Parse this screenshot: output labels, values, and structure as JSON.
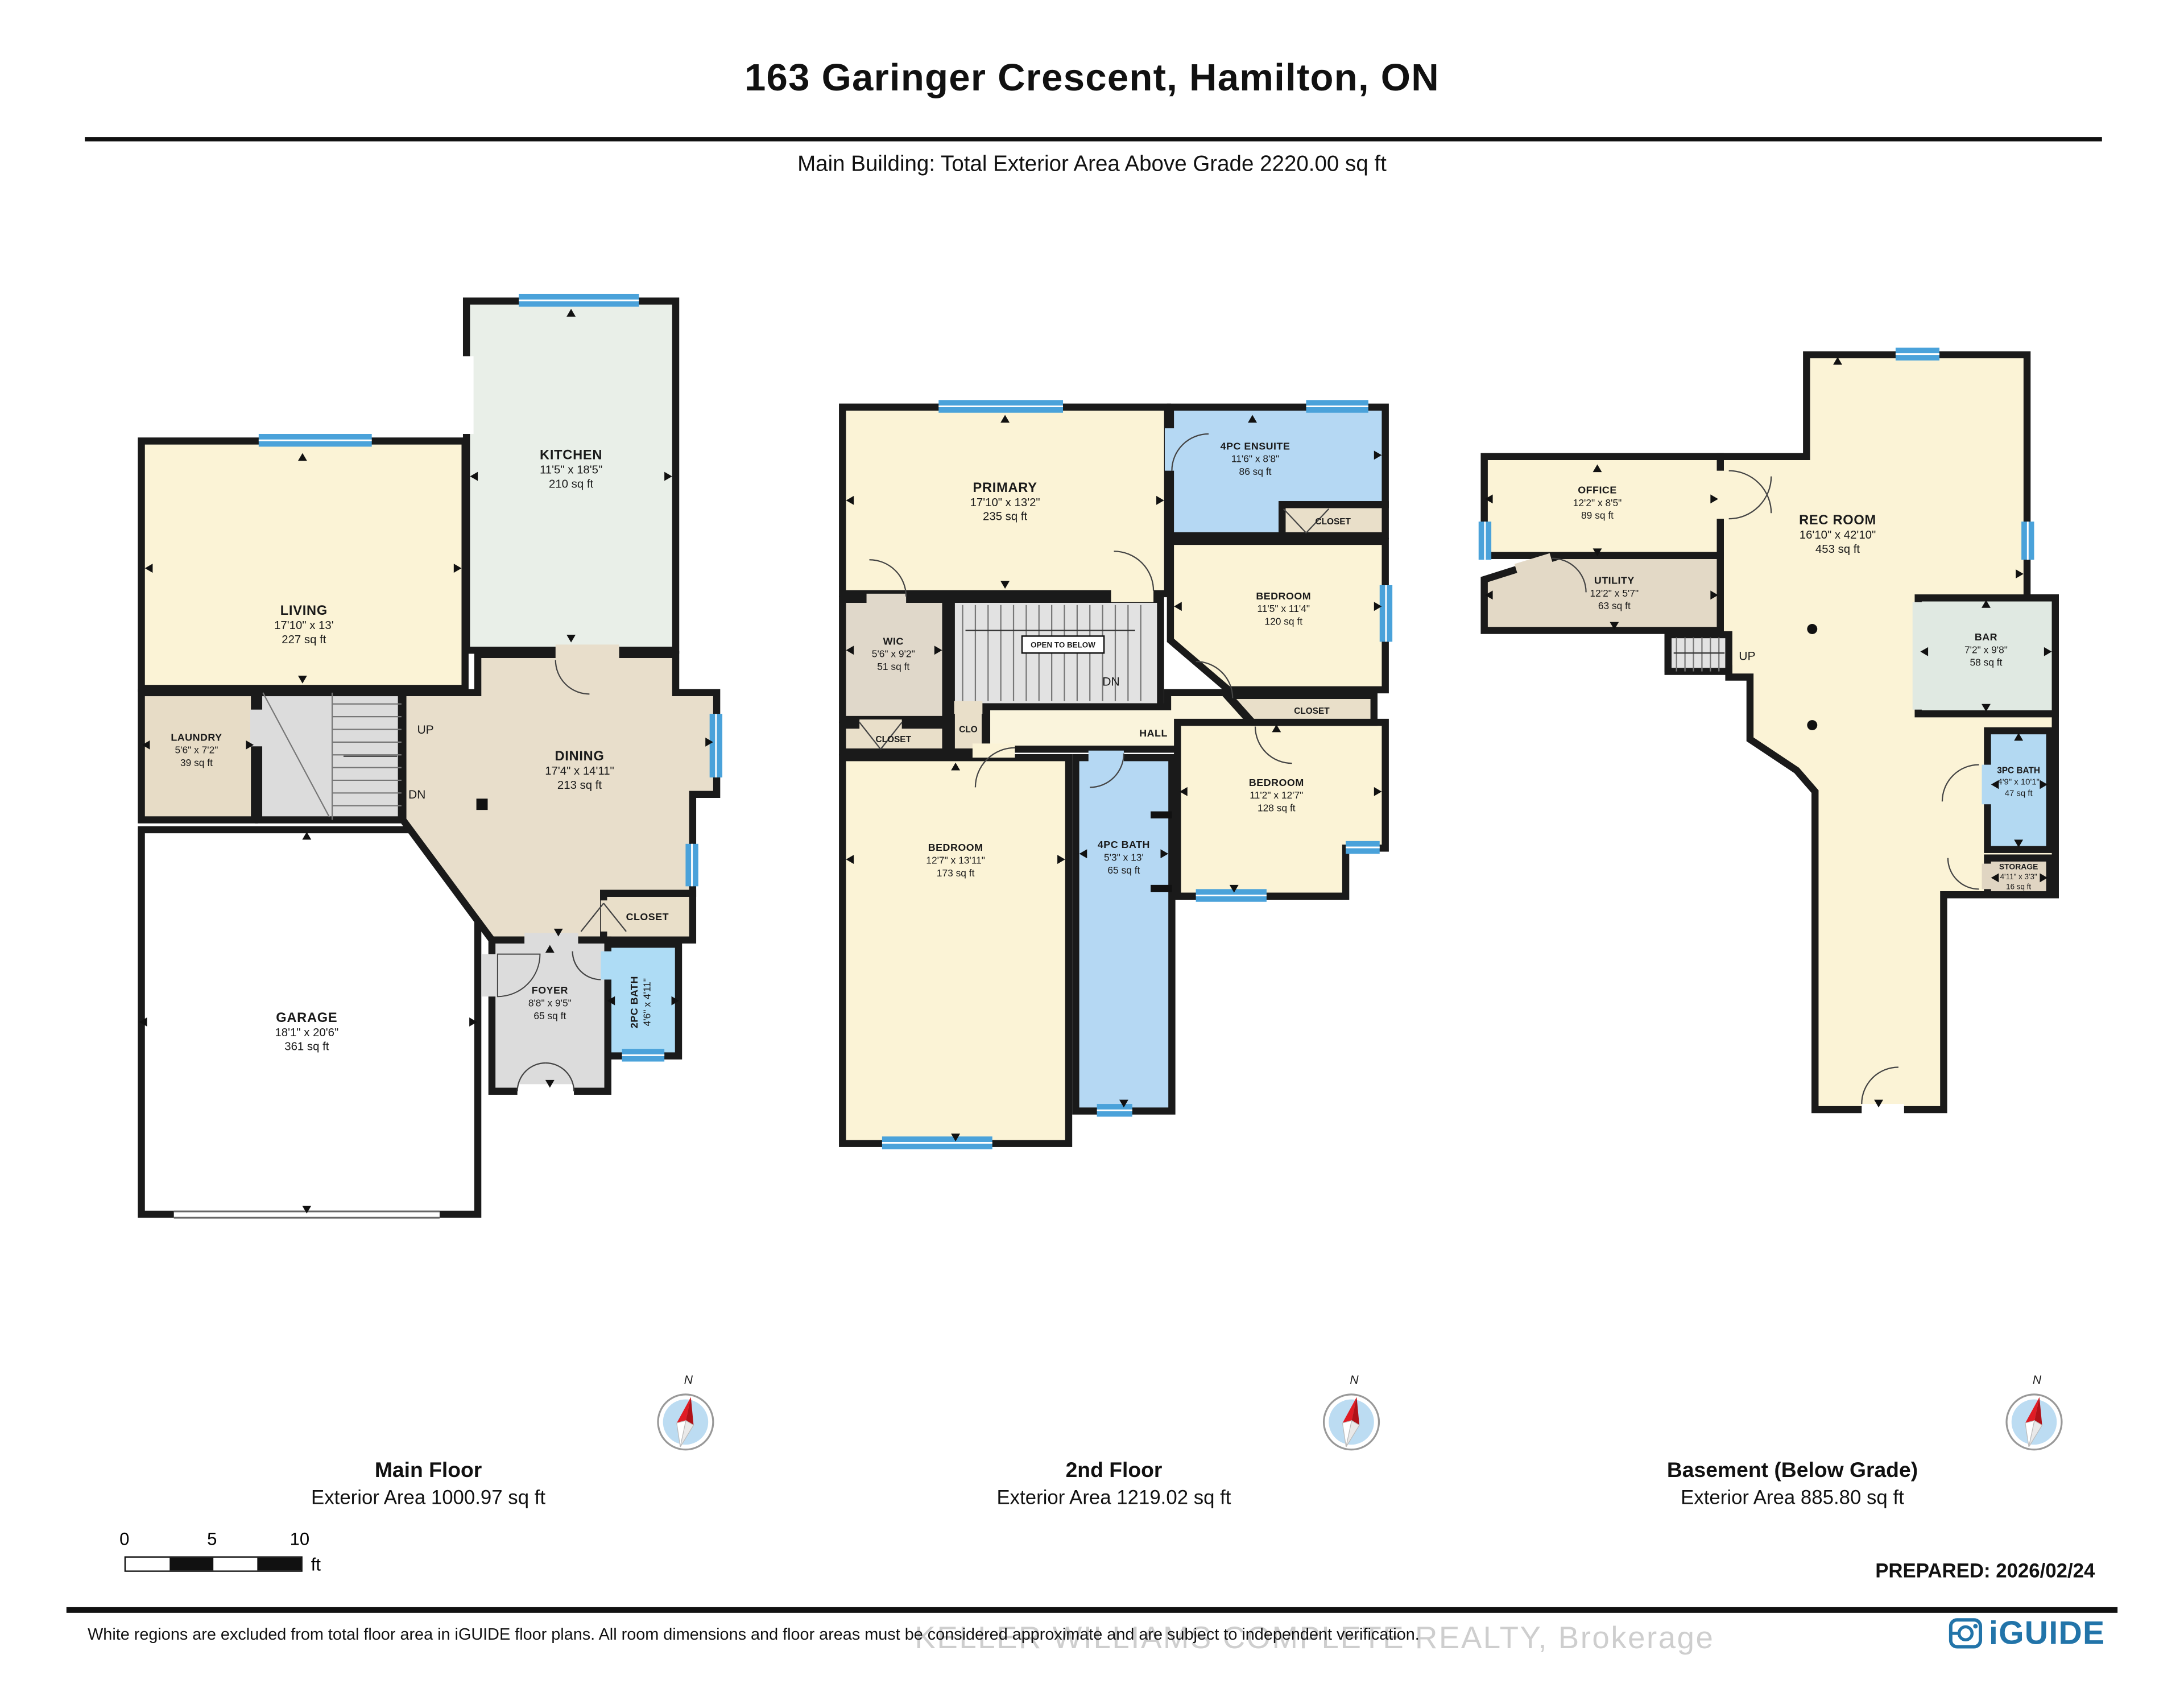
{
  "header": {
    "title": "163 Garinger Crescent, Hamilton, ON",
    "subtitle": "Main Building: Total Exterior Area Above Grade 2220.00 sq ft"
  },
  "floors": [
    {
      "name": "Main Floor",
      "area_label": "Exterior Area 1000.97 sq ft",
      "rooms": {
        "kitchen": {
          "name": "KITCHEN",
          "dims": "11'5\" x 18'5\"",
          "area": "210 sq ft"
        },
        "living": {
          "name": "LIVING",
          "dims": "17'10\" x 13'",
          "area": "227 sq ft"
        },
        "laundry": {
          "name": "LAUNDRY",
          "dims": "5'6\" x 7'2\"",
          "area": "39 sq ft"
        },
        "dining": {
          "name": "DINING",
          "dims": "17'4\" x 14'11\"",
          "area": "213 sq ft"
        },
        "garage": {
          "name": "GARAGE",
          "dims": "18'1\" x 20'6\"",
          "area": "361 sq ft"
        },
        "foyer": {
          "name": "FOYER",
          "dims": "8'8\" x 9'5\"",
          "area": "65 sq ft"
        },
        "closet": {
          "name": "CLOSET"
        },
        "bath": {
          "name": "2PC BATH",
          "dims": "4'6\" x 4'11\""
        },
        "up": "UP",
        "dn": "DN"
      }
    },
    {
      "name": "2nd Floor",
      "area_label": "Exterior Area 1219.02 sq ft",
      "rooms": {
        "primary": {
          "name": "PRIMARY",
          "dims": "17'10\" x 13'2\"",
          "area": "235 sq ft"
        },
        "ensuite": {
          "name": "4PC ENSUITE",
          "dims": "11'6\" x 8'8\"",
          "area": "86 sq ft"
        },
        "ensuite_closet": {
          "name": "CLOSET"
        },
        "bedroom2": {
          "name": "BEDROOM",
          "dims": "11'5\" x 11'4\"",
          "area": "120 sq ft"
        },
        "wic": {
          "name": "WIC",
          "dims": "5'6\" x 9'2\"",
          "area": "51 sq ft"
        },
        "open_below": {
          "name": "OPEN TO BELOW"
        },
        "hall": {
          "name": "HALL"
        },
        "closet_left": {
          "name": "CLOSET"
        },
        "clo": {
          "name": "CLO"
        },
        "bedroom3": {
          "name": "BEDROOM",
          "dims": "12'7\" x 13'11\"",
          "area": "173 sq ft"
        },
        "bath": {
          "name": "4PC BATH",
          "dims": "5'3\" x 13'",
          "area": "65 sq ft"
        },
        "bedroom4": {
          "name": "BEDROOM",
          "dims": "11'2\" x 12'7\"",
          "area": "128 sq ft"
        },
        "closet_right": {
          "name": "CLOSET"
        },
        "dn": "DN"
      }
    },
    {
      "name": "Basement (Below Grade)",
      "area_label": "Exterior Area 885.80 sq ft",
      "rooms": {
        "office": {
          "name": "OFFICE",
          "dims": "12'2\" x 8'5\"",
          "area": "89 sq ft"
        },
        "utility": {
          "name": "UTILITY",
          "dims": "12'2\" x 5'7\"",
          "area": "63 sq ft"
        },
        "rec": {
          "name": "REC ROOM",
          "dims": "16'10\" x 42'10\"",
          "area": "453 sq ft"
        },
        "bar": {
          "name": "BAR",
          "dims": "7'2\" x 9'8\"",
          "area": "58 sq ft"
        },
        "bath": {
          "name": "3PC BATH",
          "dims": "4'9\" x 10'1\"",
          "area": "47 sq ft"
        },
        "storage": {
          "name": "STORAGE",
          "dims": "4'11\" x 3'3\"",
          "area": "16 sq ft"
        },
        "up": "UP"
      }
    }
  ],
  "compass": {
    "north_label": "N"
  },
  "scale_bar": {
    "zero": "0",
    "five": "5",
    "ten": "10",
    "unit": "ft"
  },
  "footer": {
    "prepared": "PREPARED: 2026/02/24",
    "disclaimer": "White regions are excluded from total floor area in iGUIDE floor plans. All room dimensions and floor areas must be considered approximate and are subject to independent verification.",
    "watermark": "KELLER WILLIAMS COMPLETE REALTY, Brokerage",
    "brand": "iGUIDE"
  },
  "colors": {
    "wall": "#1a1a1a",
    "window_blue": "#4aa2da",
    "room_cream": "#fbf3d6",
    "room_mint": "#e9efe8",
    "room_tan": "#e7dcc6",
    "room_gray": "#dcdcdc",
    "room_bath_blue": "#b0d9f2",
    "brand_blue": "#2274a9"
  }
}
